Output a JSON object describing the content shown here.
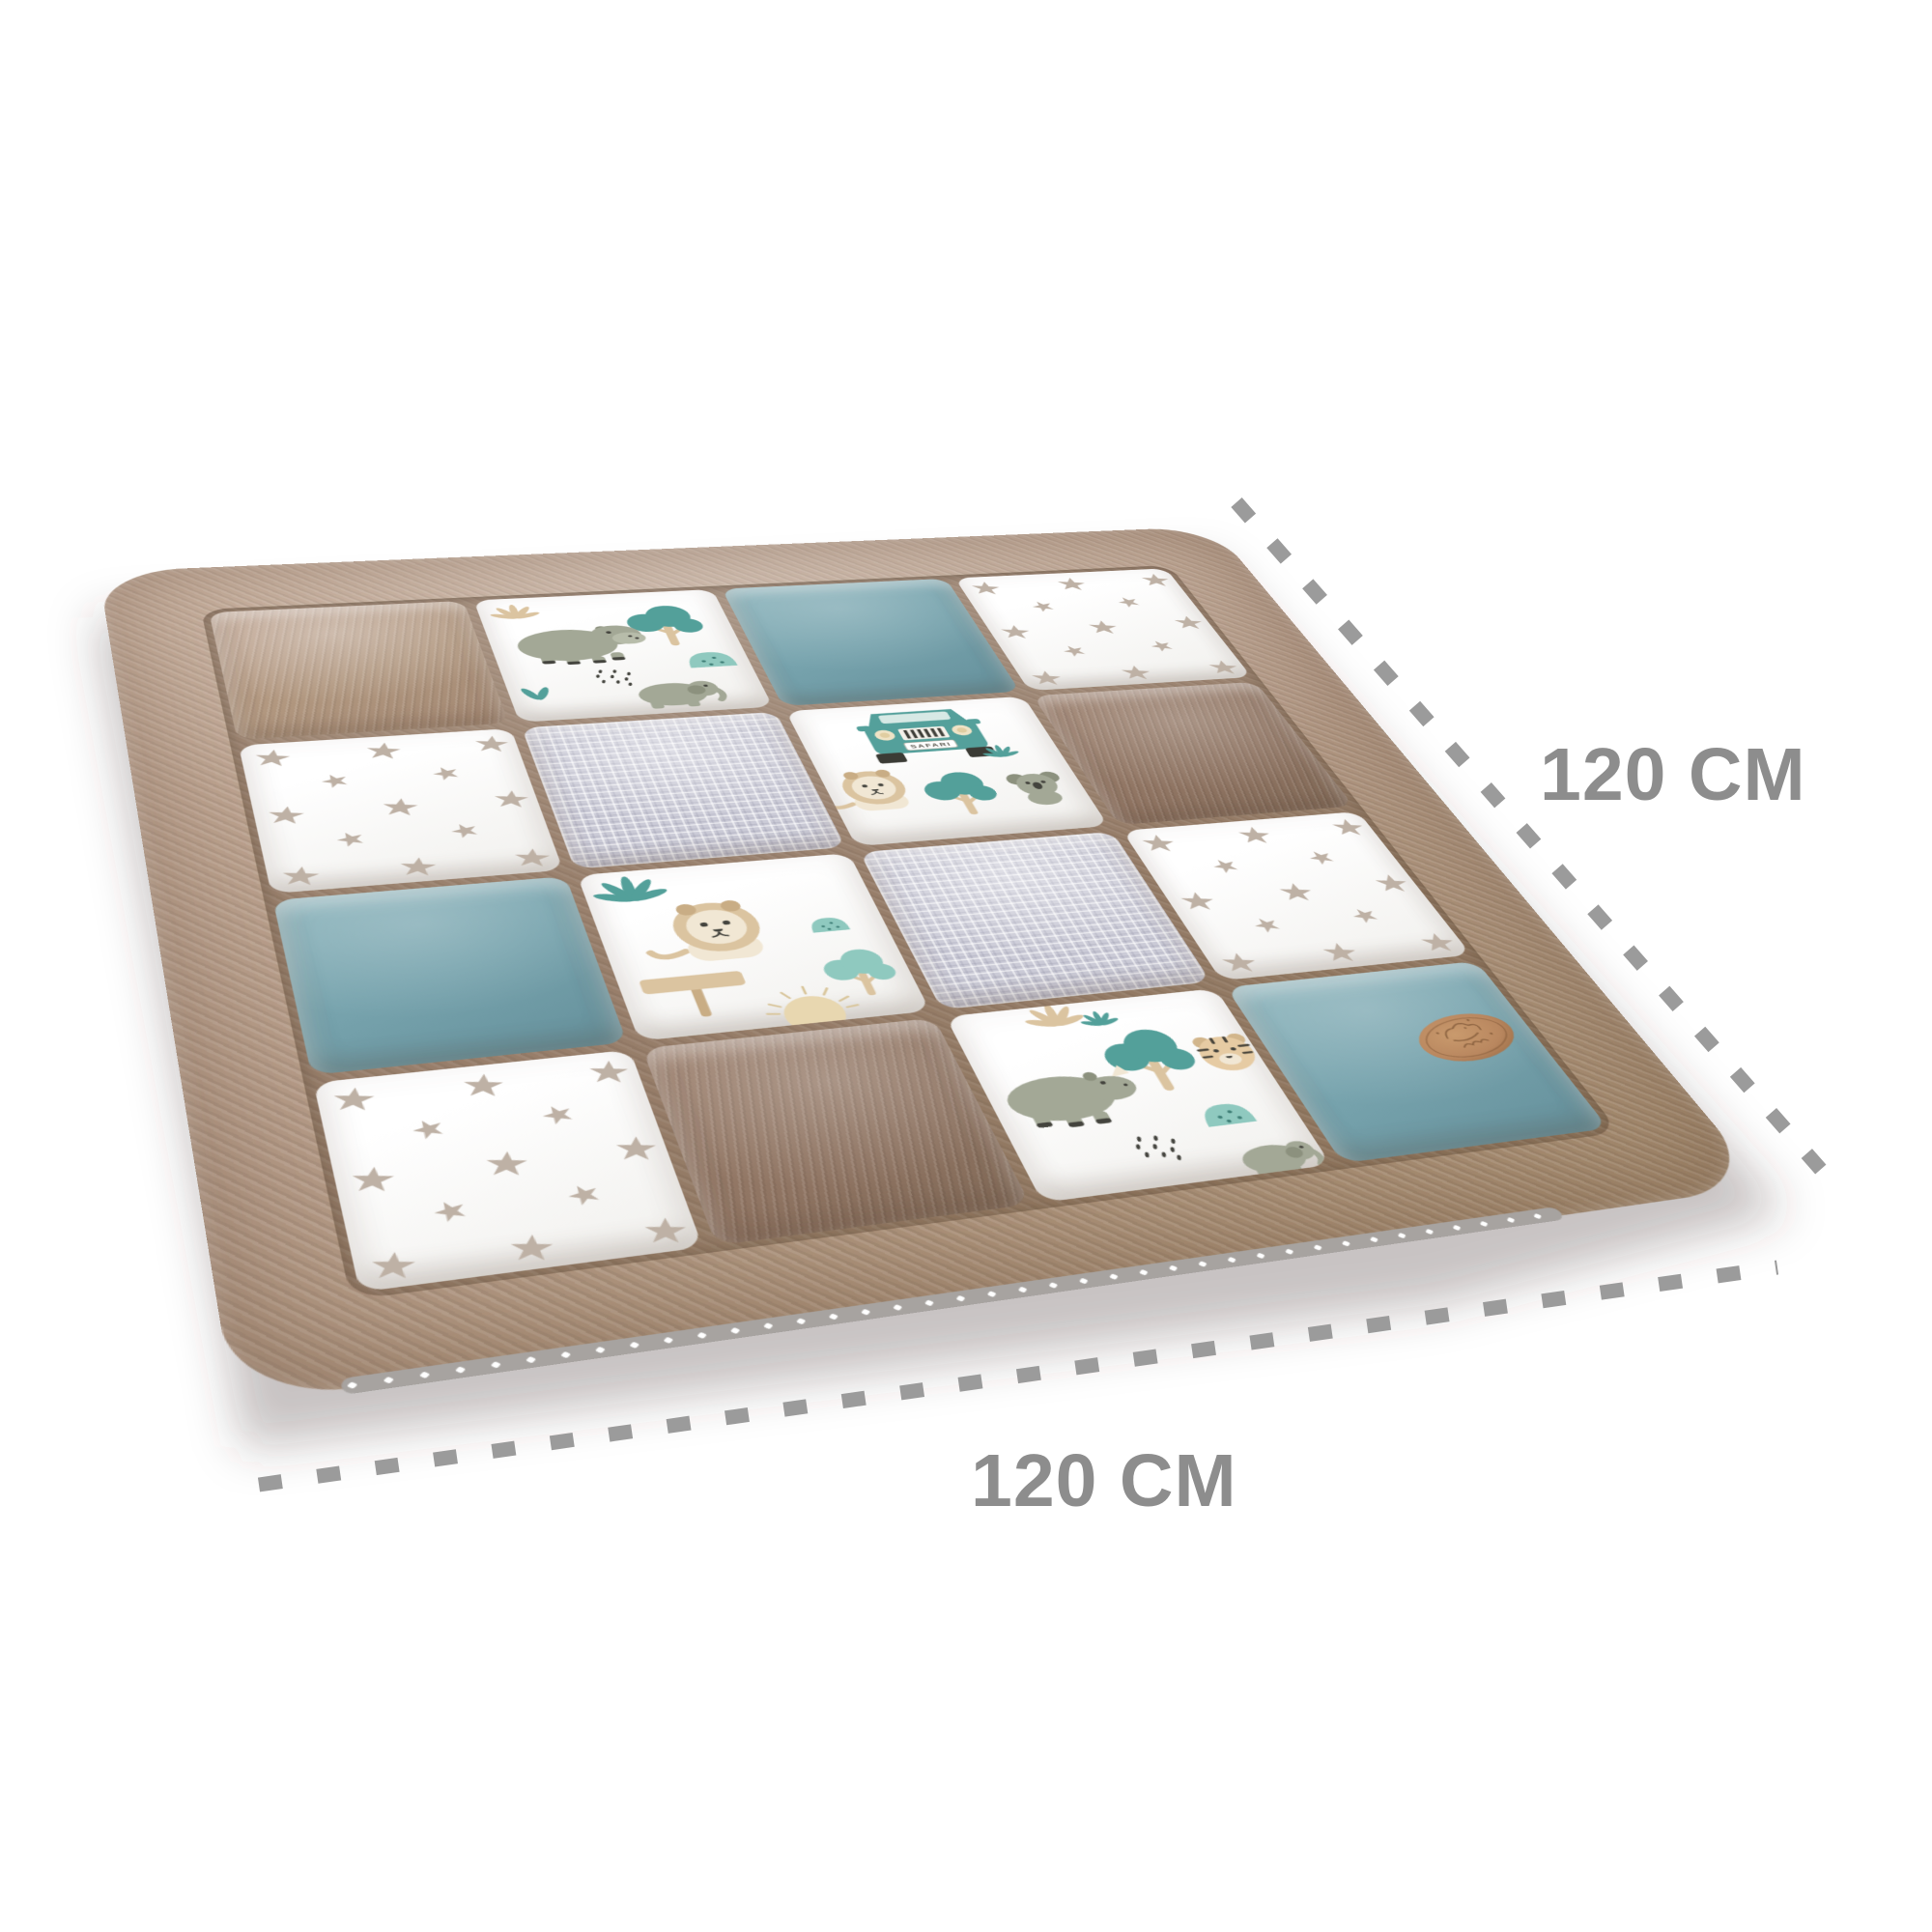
{
  "annotations": {
    "height_label": "120 CM",
    "width_label": "120 CM"
  },
  "mat": {
    "plate_text": "SAFARI",
    "badge_present": true,
    "grid": [
      [
        "velvet-taupe",
        "safari-hippo",
        "teal",
        "stars"
      ],
      [
        "stars",
        "waffle",
        "safari-jeep",
        "velvet-brown"
      ],
      [
        "teal",
        "safari-lion",
        "waffle",
        "stars"
      ],
      [
        "stars",
        "velvet-brown",
        "safari-rhino",
        "teal-badge"
      ]
    ],
    "fabric_legend": {
      "velvet-taupe": "light taupe velvet",
      "velvet-brown": "brown velvet",
      "teal": "plain teal cotton",
      "teal-badge": "plain teal cotton with leather brand badge",
      "waffle": "light lavender-grey waffle pique",
      "stars": "white cotton with taupe stars",
      "safari-hippo": "white safari print: hippo, tree, bush, rain dots, elephant",
      "safari-jeep": "white safari print: safari jeep, lion, tree, koala",
      "safari-lion": "white safari print: palm leaf, lion, signpost, sun, tree",
      "safari-rhino": "white safari print: rhino, tree, tiger, bush, elephant"
    }
  },
  "colors": {
    "label_grey": "#8d8d8d",
    "dash_grey": "#9b9b9b",
    "border_taupe": "#b29884",
    "velvet_brown": "#8f7462",
    "teal": "#77a3ad",
    "waffle_lavender": "#cbcbd7",
    "star_taupe": "#beb1a5",
    "safari_teal": "#53a09a",
    "safari_mint": "#8fc9bf",
    "safari_sage": "#a3a896",
    "safari_beige": "#dbc4a0",
    "badge_tan": "#b9875f",
    "background": "#ffffff"
  }
}
